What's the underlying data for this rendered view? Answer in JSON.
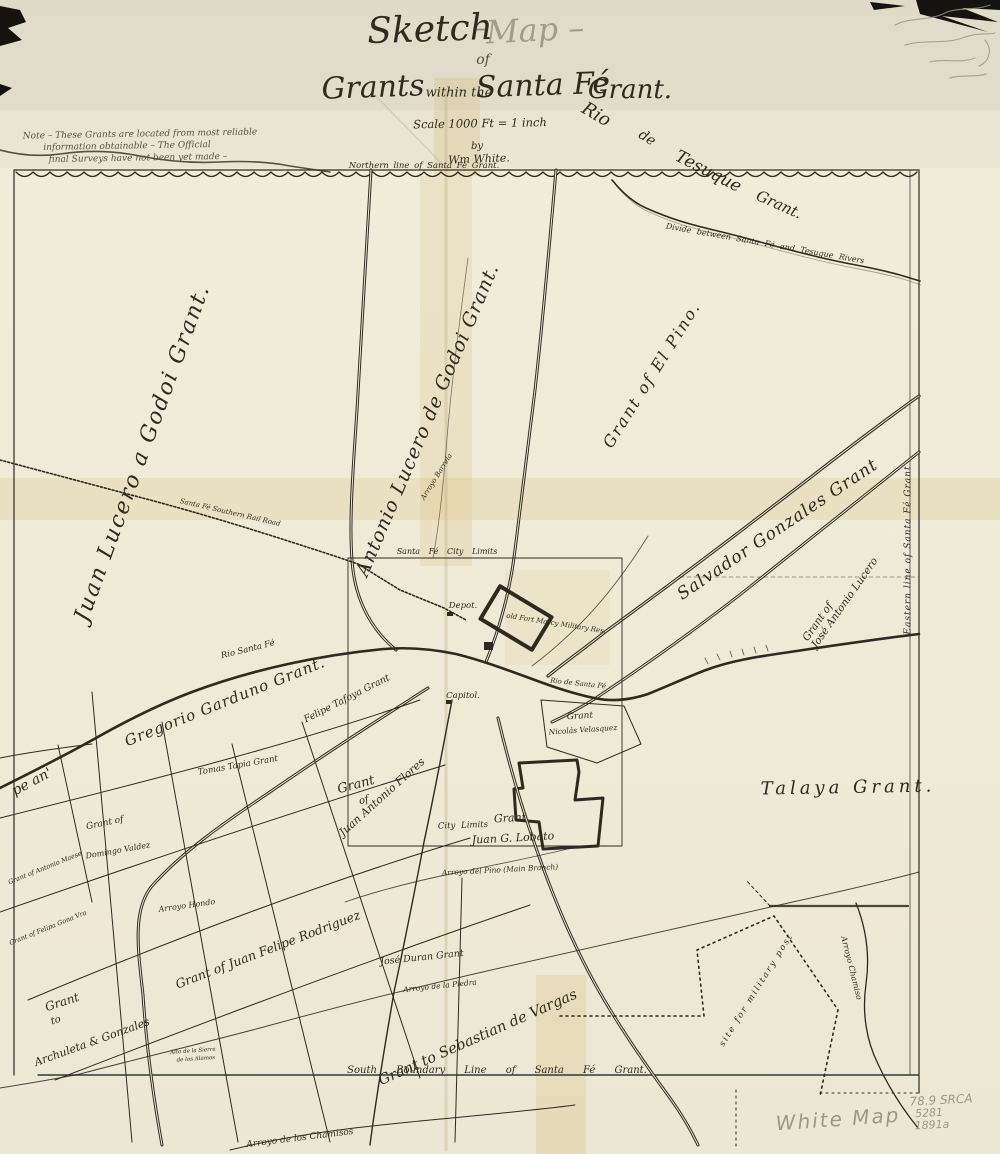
{
  "colors": {
    "paper": "#efead6",
    "ink": "#2e2a1f",
    "pencil": "#9e978a",
    "tape": "rgba(209,178,96,0.22)"
  },
  "label_groups": {
    "title": [
      {
        "name": "map-title-sketch",
        "text": "Sketch",
        "x": 430,
        "y": 30,
        "r": -2,
        "s": 36
      },
      {
        "name": "map-title-dash",
        "text": "–",
        "x": 479,
        "y": 28,
        "r": 0,
        "s": 28,
        "o": 0.45
      },
      {
        "name": "map-title-map",
        "text": "Map –",
        "x": 535,
        "y": 30,
        "r": -3,
        "s": 32,
        "o": 0.35
      },
      {
        "name": "map-title-of",
        "text": "of",
        "x": 483,
        "y": 60,
        "r": 0,
        "s": 14,
        "o": 0.8
      },
      {
        "name": "map-title-grants",
        "text": "Grants",
        "x": 373,
        "y": 88,
        "r": -2,
        "s": 30
      },
      {
        "name": "map-title-within",
        "text": "within the",
        "x": 459,
        "y": 93,
        "r": 0,
        "s": 13
      },
      {
        "name": "map-title-santafe",
        "text": "Santa Fé",
        "x": 543,
        "y": 86,
        "r": -2,
        "s": 30
      },
      {
        "name": "map-title-grantword",
        "text": "Grant.",
        "x": 630,
        "y": 90,
        "r": 0,
        "s": 26
      },
      {
        "name": "map-scale",
        "text": "Scale 1000 Ft = 1 inch",
        "x": 480,
        "y": 124,
        "r": -1,
        "s": 11.5
      },
      {
        "name": "map-by",
        "text": "by",
        "x": 477,
        "y": 147,
        "r": 0,
        "s": 10
      },
      {
        "name": "map-author",
        "text": "Wm White.",
        "x": 479,
        "y": 159,
        "r": -2,
        "s": 11
      }
    ],
    "note": [
      {
        "name": "note-line-1",
        "text": "Note – These Grants are located from most reliable",
        "x": 140,
        "y": 135,
        "r": -1,
        "s": 9,
        "cls": "faded"
      },
      {
        "name": "note-line-2",
        "text": "information obtainable – The Official",
        "x": 127,
        "y": 147,
        "r": -1,
        "s": 9,
        "cls": "faded"
      },
      {
        "name": "note-line-3",
        "text": "final Surveys have not been yet made –",
        "x": 138,
        "y": 159,
        "r": -1,
        "s": 9,
        "cls": "faded"
      }
    ],
    "boundaries": [
      {
        "name": "north-boundary-label",
        "text": "Northern line of Santa Fé Grant.",
        "x": 424,
        "y": 166,
        "r": 0,
        "s": 8.5,
        "ws": 2
      },
      {
        "name": "south-boundary-label",
        "text": "South Boundary Line of Santa Fé Grant.",
        "x": 497,
        "y": 1071,
        "r": 0,
        "s": 10,
        "ws": 16
      },
      {
        "name": "east-boundary-label",
        "text": "Eastern line of Santa Fé Grant",
        "x": 909,
        "y": 550,
        "r": -90,
        "s": 9,
        "ls": 1
      },
      {
        "name": "divide-label",
        "text": "Divide between Santa Fé and Tesuque Rivers",
        "x": 765,
        "y": 244,
        "r": 10,
        "s": 8,
        "ws": 3
      },
      {
        "name": "city-limits-top-label",
        "text": "Santa Fé City Limits",
        "x": 447,
        "y": 552,
        "r": 0,
        "s": 8,
        "ws": 6
      },
      {
        "name": "city-limits-bottom-label",
        "text": "City Limits",
        "x": 463,
        "y": 826,
        "r": -2,
        "s": 8.5,
        "ws": 3
      }
    ],
    "water_roads": [
      {
        "name": "rio-tesuque-word-1",
        "text": "Rio",
        "x": 596,
        "y": 115,
        "r": 30,
        "s": 18
      },
      {
        "name": "rio-tesuque-word-2",
        "text": "de",
        "x": 647,
        "y": 138,
        "r": 32,
        "s": 14
      },
      {
        "name": "rio-tesuque-word-3",
        "text": "Tesuque",
        "x": 708,
        "y": 172,
        "r": 27,
        "s": 17
      },
      {
        "name": "rio-tesuque-word-4",
        "text": "Grant.",
        "x": 779,
        "y": 205,
        "r": 24,
        "s": 15
      },
      {
        "name": "rio-santa-fe-label-west",
        "text": "Rio Santa Fé",
        "x": 248,
        "y": 650,
        "r": -14,
        "s": 8.5
      },
      {
        "name": "rio-santa-fe-label-city",
        "text": "Rio de Santa Fé",
        "x": 578,
        "y": 684,
        "r": 6,
        "s": 7
      },
      {
        "name": "arroyo-hondo-label",
        "text": "Arroyo Hondo",
        "x": 187,
        "y": 906,
        "r": -8,
        "s": 8
      },
      {
        "name": "arroyo-piedra-label",
        "text": "Arroyo de la Piedra",
        "x": 440,
        "y": 986,
        "r": -6,
        "s": 7.5
      },
      {
        "name": "arroyo-pino-label",
        "text": "Arroyo del Pino  (Main Branch)",
        "x": 500,
        "y": 870,
        "r": -3,
        "s": 7.5
      },
      {
        "name": "arroyo-chamiso-label",
        "text": "Arroyo Chamiso",
        "x": 851,
        "y": 968,
        "r": 76,
        "s": 8
      },
      {
        "name": "arroyo-chamisos-label",
        "text": "Arroyo de los Chamisos",
        "x": 300,
        "y": 1139,
        "r": -7,
        "s": 9
      },
      {
        "name": "railroad-label",
        "text": "Santa Fé Southern Rail Road",
        "x": 230,
        "y": 513,
        "r": 13,
        "s": 7
      },
      {
        "name": "arroyo-barrela-label",
        "text": "Arroyo Barrela",
        "x": 437,
        "y": 477,
        "r": -58,
        "s": 7
      },
      {
        "name": "military-post-label",
        "text": "site for military post",
        "x": 757,
        "y": 990,
        "r": -58,
        "s": 8.5,
        "ls": 2
      }
    ],
    "grants": [
      {
        "name": "grant-juan-lucero",
        "text": "Juan Lucero a Godoi Grant.",
        "x": 143,
        "y": 453,
        "r": -70,
        "s": 22,
        "ls": 2
      },
      {
        "name": "grant-antonio-lucero",
        "text": "Antonio Lucero de Godoi Grant.",
        "x": 428,
        "y": 420,
        "r": -67,
        "s": 19,
        "ls": 1
      },
      {
        "name": "grant-el-pino",
        "text": "Grant of El Pino.",
        "x": 652,
        "y": 375,
        "r": -58,
        "s": 16,
        "ls": 2
      },
      {
        "name": "grant-salvador-gonzales",
        "text": "Salvador Gonzales Grant",
        "x": 778,
        "y": 530,
        "r": -34,
        "s": 17,
        "ls": 1
      },
      {
        "name": "grant-jose-antonio-lucero-1",
        "text": "Grant of",
        "x": 818,
        "y": 622,
        "r": -55,
        "s": 10.5
      },
      {
        "name": "grant-jose-antonio-lucero-2",
        "text": "José Antonio Lucero",
        "x": 845,
        "y": 603,
        "r": -55,
        "s": 10.5
      },
      {
        "name": "grant-talaya",
        "text": "Talaya Grant.",
        "x": 848,
        "y": 788,
        "r": -1,
        "s": 18,
        "ls": 4
      },
      {
        "name": "grant-gregorio-garduno",
        "text": "Gregorio Garduno Grant.",
        "x": 225,
        "y": 702,
        "r": -22,
        "s": 15,
        "ls": 1
      },
      {
        "name": "grant-felipe-tafoya",
        "text": "Felipe Tafoya Grant",
        "x": 347,
        "y": 699,
        "r": -27,
        "s": 9.5
      },
      {
        "name": "grant-tomas-tapia",
        "text": "Tomas Tapia Grant",
        "x": 238,
        "y": 766,
        "r": -10,
        "s": 8.5
      },
      {
        "name": "grant-flores-1",
        "text": "Grant",
        "x": 356,
        "y": 785,
        "r": -15,
        "s": 13
      },
      {
        "name": "grant-flores-2",
        "text": "of",
        "x": 364,
        "y": 801,
        "r": -15,
        "s": 10
      },
      {
        "name": "grant-flores-3",
        "text": "Juan Antonio Flores",
        "x": 382,
        "y": 797,
        "r": -42,
        "s": 11
      },
      {
        "name": "grant-lobato-1",
        "text": "Grant",
        "x": 510,
        "y": 818,
        "r": -3,
        "s": 11
      },
      {
        "name": "grant-lobato-2",
        "text": "Juan G. Lobato",
        "x": 513,
        "y": 838,
        "r": -3,
        "s": 11
      },
      {
        "name": "grant-velasquez-1",
        "text": "Grant",
        "x": 580,
        "y": 717,
        "r": -4,
        "s": 9
      },
      {
        "name": "grant-velasquez-2",
        "text": "Nicolás Velasquez",
        "x": 583,
        "y": 730,
        "r": -4,
        "s": 7.5
      },
      {
        "name": "grant-juan-felipe-rodriguez",
        "text": "Grant of Juan Felipe Rodriguez",
        "x": 268,
        "y": 950,
        "r": -21,
        "s": 12.5
      },
      {
        "name": "grant-jose-duran",
        "text": "José Duran Grant",
        "x": 422,
        "y": 958,
        "r": -6,
        "s": 9.5
      },
      {
        "name": "grant-sebastian-vargas",
        "text": "Grant to Sebastian de Vargas",
        "x": 478,
        "y": 1038,
        "r": -24,
        "s": 14.5
      },
      {
        "name": "grant-archuleta-1",
        "text": "Grant",
        "x": 62,
        "y": 1002,
        "r": -18,
        "s": 12
      },
      {
        "name": "grant-archuleta-2",
        "text": "to",
        "x": 56,
        "y": 1021,
        "r": -18,
        "s": 10
      },
      {
        "name": "grant-archuleta-3",
        "text": "Archuleta & Gonzales",
        "x": 92,
        "y": 1042,
        "r": -20,
        "s": 11
      },
      {
        "name": "grant-domingo-1",
        "text": "Grant of",
        "x": 105,
        "y": 824,
        "r": -12,
        "s": 9
      },
      {
        "name": "grant-domingo-2",
        "text": "Domingo Valdez",
        "x": 118,
        "y": 851,
        "r": -10,
        "s": 8
      },
      {
        "name": "grant-antonio-maese",
        "text": "Grant of Antonio Maese",
        "x": 45,
        "y": 868,
        "r": -22,
        "s": 6.5
      },
      {
        "name": "grant-felipa",
        "text": "Grant of Felipa Gona Vra",
        "x": 48,
        "y": 928,
        "r": -22,
        "s": 6.5
      },
      {
        "name": "grant-fragment",
        "text": "pe an'",
        "x": 32,
        "y": 782,
        "r": -28,
        "s": 14
      },
      {
        "name": "alto-sierra-note-1",
        "text": "Alto de la Sierra",
        "x": 193,
        "y": 1052,
        "r": -4,
        "s": 5.5
      },
      {
        "name": "alto-sierra-note-2",
        "text": "de los Alamos",
        "x": 196,
        "y": 1060,
        "r": -4,
        "s": 5.5
      }
    ],
    "settlements": [
      {
        "name": "depot-label",
        "text": "Depot.",
        "x": 463,
        "y": 606,
        "r": 0,
        "s": 8.5
      },
      {
        "name": "capitol-label",
        "text": "Capitol.",
        "x": 463,
        "y": 696,
        "r": 0,
        "s": 8.5
      },
      {
        "name": "fort-marcy-label",
        "text": "old Fort Marcy Military Res.",
        "x": 556,
        "y": 624,
        "r": 9,
        "s": 7
      }
    ],
    "pencil": [
      {
        "name": "pencil-white-map",
        "text": "White Map",
        "x": 838,
        "y": 1119,
        "r": -4,
        "s": 20,
        "ls": 2,
        "cls": "pencil"
      },
      {
        "name": "pencil-archive-1",
        "text": "78.9 SRCA",
        "x": 941,
        "y": 1100,
        "r": -3,
        "s": 12,
        "cls": "pencil"
      },
      {
        "name": "pencil-archive-2",
        "text": "5281",
        "x": 929,
        "y": 1113,
        "r": -3,
        "s": 11,
        "cls": "pencil"
      },
      {
        "name": "pencil-archive-3",
        "text": "1891a",
        "x": 932,
        "y": 1125,
        "r": -3,
        "s": 11,
        "cls": "pencil"
      }
    ]
  }
}
